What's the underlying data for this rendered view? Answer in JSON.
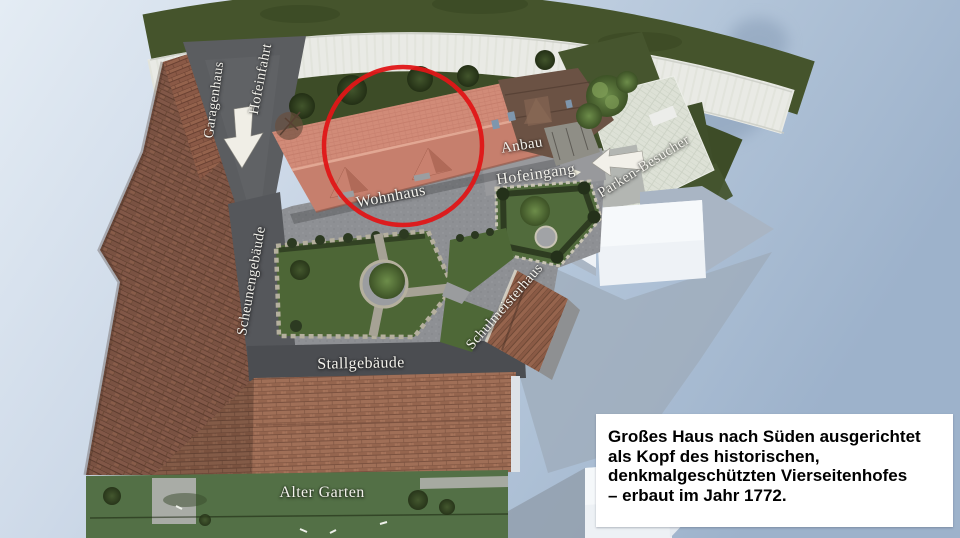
{
  "slide": {
    "map_labels": {
      "garagenhaus": "Garagenhaus",
      "hofeinfahrt": "Hofeinfahrt",
      "wohnhaus": "Wohnhaus",
      "anbau": "Anbau",
      "hofeingang": "Hofeingang",
      "parken_besucher": "Parken-Besucher",
      "scheunengebaeude": "Scheunengebäude",
      "schulmeisterhaus": "Schulmeisterhaus",
      "stallgebaeude": "Stallgebäude",
      "alter_garten": "Alter Garten"
    },
    "annotation_box": {
      "lines": [
        "Großes Haus nach Süden ausgerichtet",
        "als Kopf des historischen,",
        "denkmalgeschützten Vierseitenhofes",
        "– erbaut im Jahr 1772."
      ],
      "background": "#ffffff",
      "text_color": "#000000"
    },
    "colors": {
      "highlight_circle": "#e01617",
      "wohnhaus_roof": "#d18b78",
      "label_text": "#f3f2ec",
      "sky_left": "#e4ecf4",
      "sky_right": "#9db2cb",
      "lawn_green": "#4e6837",
      "courtyard_grey": "#8e9094",
      "arrow_white": "#f0eee6"
    },
    "icons": {
      "highlight_circle": "red emphasis circle around Wohnhaus roof",
      "down_arrow": "courtyard driveway entrance direction",
      "left_arrow": "visitor parking direction"
    }
  }
}
